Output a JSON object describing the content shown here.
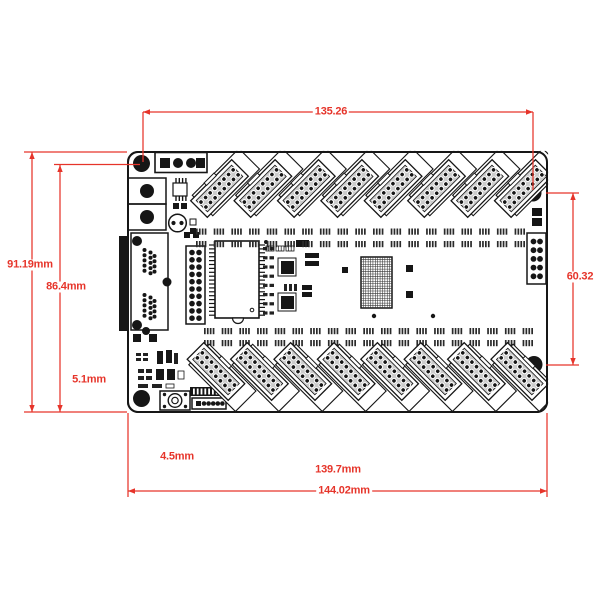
{
  "dimensions": {
    "width_top": "135.26",
    "height_full": "91.19mm",
    "height_inner": "86.4mm",
    "height_right": "60.32",
    "offset_bottom_left": "5.1mm",
    "offset_bottom": "4.5mm",
    "width_inner": "139.7mm",
    "width_full": "144.02mm"
  },
  "colors": {
    "dimension": "#e6342a",
    "line": "#161616",
    "connector_fill": "#cbcbcb",
    "background": "#ffffff"
  },
  "board": {
    "top_connector_count": 8,
    "bottom_connector_count": 8,
    "connector_dot_rows": 8,
    "connector_dot_cols": 2,
    "mounting_hole_count": 4
  }
}
